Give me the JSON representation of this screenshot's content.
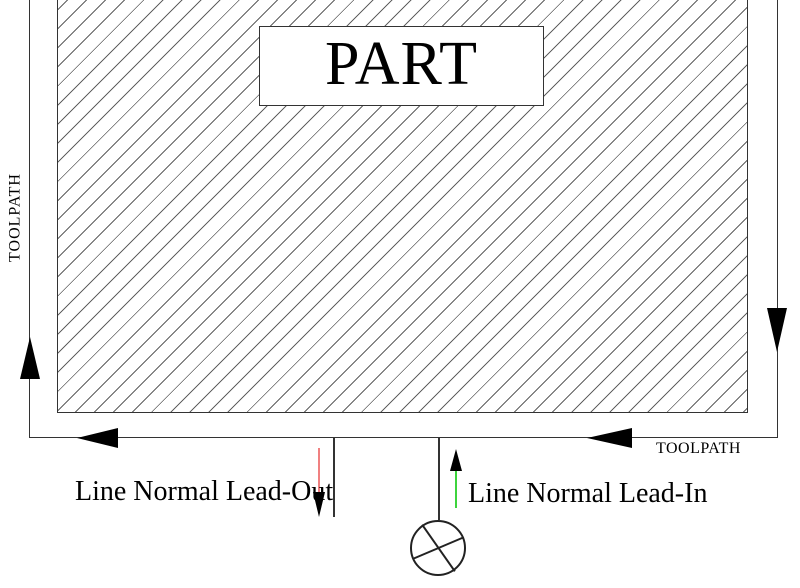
{
  "diagram": {
    "part": {
      "label": "PART"
    },
    "toolpath": {
      "label_left": "TOOLPATH",
      "label_bottom": "TOOLPATH"
    },
    "lead_out": {
      "label": "Line Normal Lead-Out",
      "color": "#f08080"
    },
    "lead_in": {
      "label": "Line Normal Lead-In",
      "color": "#3dd43d"
    }
  }
}
